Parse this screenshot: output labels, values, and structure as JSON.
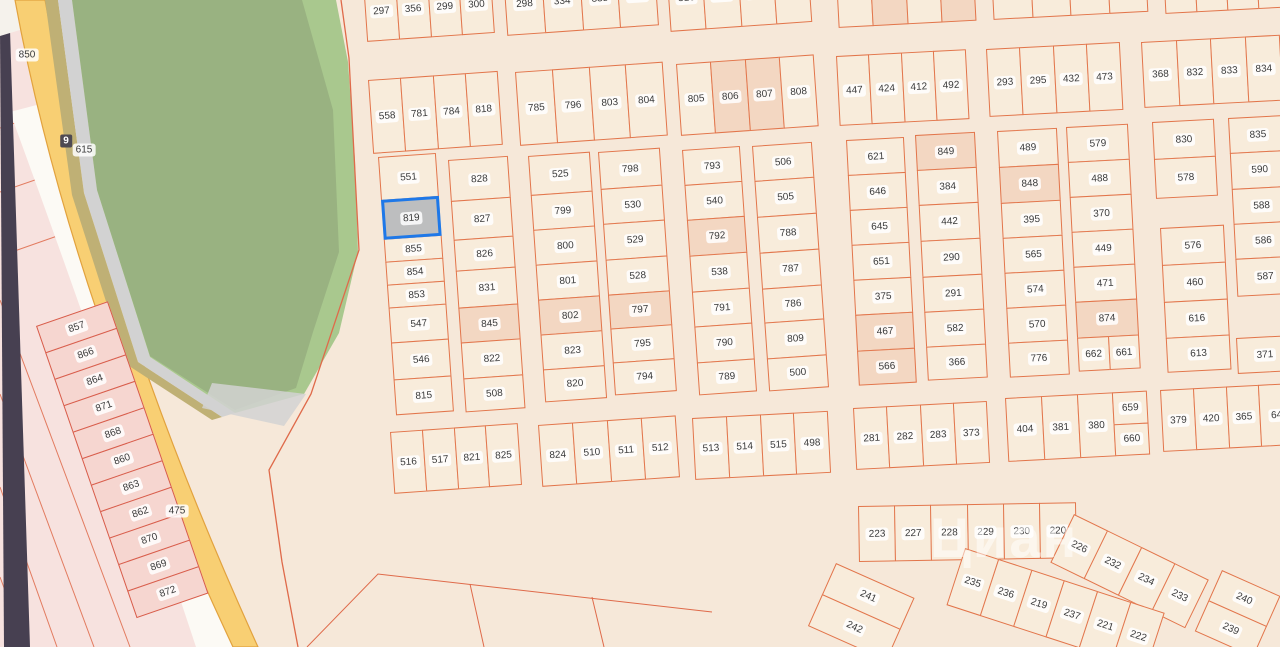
{
  "selected_plot": "819",
  "watermark": {
    "text": "Циан",
    "x": 930,
    "y": 505,
    "size": 56
  },
  "colors": {
    "bg": "#f6e8d9",
    "plot_fill": "#f8ecdb",
    "plot_shade": "#f3d7c2",
    "plot_border": "#e2754b",
    "selected_fill": "#bdbebf",
    "selected_border": "#1e78e8",
    "pink_fill": "#f6d6d0",
    "pink_border": "#d85c4a",
    "label_bg": "rgba(255,255,255,0.85)",
    "label_color": "#3a3a3a",
    "green": "#a9c88e",
    "green_dim": "rgba(95,100,85,0.22)",
    "gray_strip": "#d2d2d2",
    "road_yellow": "#f8cf73",
    "road_edge": "#e2a23e",
    "olive": "#bfb075",
    "white_road": "#fcfaf5",
    "pink_area": "#f7e2df",
    "purple": "#474051",
    "red_line": "#df6a4a",
    "white_wedge": "#f5f2ec",
    "watermark": "rgba(255,255,255,0.5)",
    "badge_dark_bg": "#4e4a52",
    "badge_dark_color": "#ffffff"
  },
  "road_labels": [
    {
      "text": "850",
      "x": 27,
      "y": 55,
      "style": "badge"
    },
    {
      "text": "9",
      "x": 66,
      "y": 141,
      "style": "dark-badge"
    },
    {
      "text": "615",
      "x": 84,
      "y": 150,
      "style": "badge"
    },
    {
      "text": "475",
      "x": 177,
      "y": 511,
      "style": "badge"
    }
  ],
  "blocks": [
    {
      "id": "r1a",
      "kind": "row",
      "x": 363,
      "y": -18,
      "w": 128,
      "h": 60,
      "rot": -4,
      "cells": [
        "297",
        "356",
        "299",
        "300"
      ]
    },
    {
      "id": "r1b",
      "kind": "row",
      "x": 503,
      "y": -26,
      "w": 152,
      "h": 62,
      "rot": -4,
      "cells": [
        "298",
        "334",
        "335",
        "336"
      ]
    },
    {
      "id": "r1c",
      "kind": "row",
      "x": 666,
      "y": -34,
      "w": 142,
      "h": 66,
      "rot": -4,
      "cells": [
        "316",
        "317",
        "318",
        "319"
      ]
    },
    {
      "id": "r1d",
      "kind": "row",
      "x": 835,
      "y": -42,
      "w": 138,
      "h": 70,
      "rot": -3,
      "cells": [
        "",
        {
          "n": "",
          "shade": true
        },
        "",
        {
          "n": "",
          "shade": true
        }
      ]
    },
    {
      "id": "r1e",
      "kind": "row",
      "x": 990,
      "y": -48,
      "w": 155,
      "h": 68,
      "rot": -3,
      "cells": [
        "",
        "",
        "",
        ""
      ]
    },
    {
      "id": "r1f",
      "kind": "row",
      "x": 1162,
      "y": -52,
      "w": 125,
      "h": 66,
      "rot": -3,
      "cells": [
        "",
        "",
        "",
        ""
      ]
    },
    {
      "id": "r2a",
      "kind": "row",
      "x": 368,
      "y": 80,
      "w": 130,
      "h": 74,
      "rot": -4,
      "cells": [
        "558",
        "781",
        "784",
        "818"
      ]
    },
    {
      "id": "r2b",
      "kind": "row",
      "x": 515,
      "y": 72,
      "w": 148,
      "h": 74,
      "rot": -4,
      "cells": [
        "785",
        "796",
        "803",
        "804"
      ]
    },
    {
      "id": "r2c",
      "kind": "row",
      "x": 676,
      "y": 64,
      "w": 138,
      "h": 72,
      "rot": -4,
      "cells": [
        "805",
        {
          "n": "806",
          "shade": true
        },
        {
          "n": "807",
          "shade": true
        },
        "808"
      ]
    },
    {
      "id": "r2d",
      "kind": "row",
      "x": 836,
      "y": 56,
      "w": 130,
      "h": 70,
      "rot": -3,
      "cells": [
        "447",
        "424",
        "412",
        "492"
      ]
    },
    {
      "id": "r2e",
      "kind": "row",
      "x": 986,
      "y": 49,
      "w": 134,
      "h": 68,
      "rot": -3,
      "cells": [
        "293",
        "295",
        "432",
        "473"
      ]
    },
    {
      "id": "r2f",
      "kind": "row",
      "x": 1141,
      "y": 42,
      "w": 139,
      "h": 66,
      "rot": -3,
      "cells": [
        "368",
        "832",
        "833",
        "834"
      ]
    },
    {
      "id": "c1l",
      "kind": "col",
      "x": 378,
      "y": 157,
      "w": 58,
      "rot": -4,
      "cells": [
        {
          "n": "551",
          "h": 44
        },
        {
          "n": "819",
          "h": 40,
          "sel": true
        },
        {
          "n": "855",
          "h": 24
        },
        {
          "n": "854",
          "h": 24
        },
        {
          "n": "853",
          "h": 24
        },
        {
          "n": "547",
          "h": 36
        },
        {
          "n": "546",
          "h": 38
        },
        {
          "n": "815",
          "h": 36
        }
      ]
    },
    {
      "id": "c1r",
      "kind": "col",
      "x": 448,
      "y": 160,
      "w": 60,
      "rot": -4,
      "cells": [
        {
          "n": "828",
          "h": 42
        },
        {
          "n": "827",
          "h": 40
        },
        {
          "n": "826",
          "h": 32
        },
        {
          "n": "831",
          "h": 38
        },
        {
          "n": "845",
          "h": 36,
          "shade": true
        },
        {
          "n": "822",
          "h": 37
        },
        {
          "n": "508",
          "h": 34
        }
      ]
    },
    {
      "id": "c2l",
      "kind": "col",
      "x": 528,
      "y": 156,
      "w": 62,
      "rot": -4,
      "cells": [
        {
          "n": "525",
          "h": 40
        },
        {
          "n": "799",
          "h": 36
        },
        {
          "n": "800",
          "h": 36
        },
        {
          "n": "801",
          "h": 36
        },
        {
          "n": "802",
          "h": 36,
          "shade": true
        },
        {
          "n": "823",
          "h": 36
        },
        {
          "n": "820",
          "h": 33
        }
      ]
    },
    {
      "id": "c2r",
      "kind": "col",
      "x": 598,
      "y": 152,
      "w": 62,
      "rot": -4,
      "cells": [
        {
          "n": "798",
          "h": 38
        },
        {
          "n": "530",
          "h": 36
        },
        {
          "n": "529",
          "h": 37
        },
        {
          "n": "528",
          "h": 36
        },
        {
          "n": "797",
          "h": 35,
          "shade": true
        },
        {
          "n": "795",
          "h": 35
        },
        {
          "n": "794",
          "h": 33
        }
      ]
    },
    {
      "id": "c3l",
      "kind": "col",
      "x": 682,
      "y": 150,
      "w": 58,
      "rot": -4,
      "cells": [
        {
          "n": "793",
          "h": 36
        },
        {
          "n": "540",
          "h": 36
        },
        {
          "n": "792",
          "h": 37,
          "shade": true
        },
        {
          "n": "538",
          "h": 37
        },
        {
          "n": "791",
          "h": 36
        },
        {
          "n": "790",
          "h": 37
        },
        {
          "n": "789",
          "h": 33
        }
      ]
    },
    {
      "id": "c3r",
      "kind": "col",
      "x": 752,
      "y": 146,
      "w": 60,
      "rot": -4,
      "cells": [
        {
          "n": "506",
          "h": 36
        },
        {
          "n": "505",
          "h": 37
        },
        {
          "n": "788",
          "h": 37
        },
        {
          "n": "787",
          "h": 37
        },
        {
          "n": "786",
          "h": 35
        },
        {
          "n": "809",
          "h": 37
        },
        {
          "n": "500",
          "h": 33
        }
      ]
    },
    {
      "id": "c4l",
      "kind": "col",
      "x": 846,
      "y": 140,
      "w": 58,
      "rot": -3,
      "cells": [
        {
          "n": "621",
          "h": 36
        },
        {
          "n": "646",
          "h": 36
        },
        {
          "n": "645",
          "h": 36
        },
        {
          "n": "651",
          "h": 36
        },
        {
          "n": "375",
          "h": 36
        },
        {
          "n": "467",
          "h": 37,
          "shade": true
        },
        {
          "n": "566",
          "h": 35,
          "shade": true
        }
      ]
    },
    {
      "id": "c4r",
      "kind": "col",
      "x": 915,
      "y": 135,
      "w": 60,
      "rot": -3,
      "cells": [
        {
          "n": "849",
          "h": 36,
          "shade": true
        },
        {
          "n": "384",
          "h": 36
        },
        {
          "n": "442",
          "h": 37
        },
        {
          "n": "290",
          "h": 37
        },
        {
          "n": "291",
          "h": 36
        },
        {
          "n": "582",
          "h": 36
        },
        {
          "n": "366",
          "h": 34
        }
      ]
    },
    {
      "id": "c5l",
      "kind": "col",
      "x": 997,
      "y": 131,
      "w": 60,
      "rot": -3,
      "cells": [
        {
          "n": "489",
          "h": 37
        },
        {
          "n": "848",
          "h": 37,
          "shade": true
        },
        {
          "n": "395",
          "h": 36
        },
        {
          "n": "565",
          "h": 36
        },
        {
          "n": "574",
          "h": 36
        },
        {
          "n": "570",
          "h": 36
        },
        {
          "n": "776",
          "h": 35
        }
      ]
    },
    {
      "id": "c5r",
      "kind": "col",
      "x": 1066,
      "y": 127,
      "w": 62,
      "rot": -3,
      "cells": [
        {
          "n": "579",
          "h": 36
        },
        {
          "n": "488",
          "h": 36
        },
        {
          "n": "370",
          "h": 36
        },
        {
          "n": "449",
          "h": 36
        },
        {
          "n": "471",
          "h": 36
        },
        {
          "n": "874",
          "h": 37,
          "shade": true
        },
        {
          "row": [
            "662",
            "661"
          ],
          "h": 34
        }
      ]
    },
    {
      "id": "c6a",
      "kind": "col",
      "x": 1152,
      "y": 122,
      "w": 62,
      "rot": -3,
      "cells": [
        {
          "n": "830",
          "h": 38
        },
        {
          "n": "578",
          "h": 40
        }
      ]
    },
    {
      "id": "c6b",
      "kind": "col",
      "x": 1160,
      "y": 228,
      "w": 64,
      "rot": -3,
      "cells": [
        {
          "n": "576",
          "h": 38
        },
        {
          "n": "460",
          "h": 38
        },
        {
          "n": "616",
          "h": 37
        },
        {
          "n": "613",
          "h": 35
        }
      ]
    },
    {
      "id": "c6c",
      "kind": "col",
      "x": 1228,
      "y": 118,
      "w": 58,
      "rot": -3,
      "cells": [
        {
          "n": "835",
          "h": 36
        },
        {
          "n": "590",
          "h": 37
        },
        {
          "n": "588",
          "h": 36
        },
        {
          "n": "586",
          "h": 36
        },
        {
          "n": "587",
          "h": 38
        }
      ]
    },
    {
      "id": "c6d",
      "kind": "col",
      "x": 1236,
      "y": 338,
      "w": 56,
      "rot": -3,
      "cells": [
        {
          "n": "371",
          "h": 36
        }
      ]
    },
    {
      "id": "bb1",
      "kind": "row",
      "x": 390,
      "y": 432,
      "w": 128,
      "h": 62,
      "rot": -4,
      "cells": [
        "516",
        "517",
        "821",
        "825"
      ]
    },
    {
      "id": "bb2",
      "kind": "row",
      "x": 538,
      "y": 425,
      "w": 138,
      "h": 62,
      "rot": -4,
      "cells": [
        "824",
        "510",
        "511",
        "512"
      ]
    },
    {
      "id": "bb3",
      "kind": "row",
      "x": 692,
      "y": 418,
      "w": 136,
      "h": 62,
      "rot": -3,
      "cells": [
        "513",
        "514",
        "515",
        "498"
      ]
    },
    {
      "id": "bb4",
      "kind": "row",
      "x": 853,
      "y": 408,
      "w": 134,
      "h": 62,
      "rot": -3,
      "cells": [
        "281",
        "282",
        "283",
        "373"
      ]
    },
    {
      "id": "bb5",
      "kind": "row",
      "x": 1005,
      "y": 398,
      "w": 142,
      "h": 64,
      "rot": -3,
      "cells": [
        "404",
        "381",
        "380",
        {
          "stack": [
            "659",
            "660"
          ]
        }
      ]
    },
    {
      "id": "bb6",
      "kind": "row",
      "x": 1160,
      "y": 390,
      "w": 132,
      "h": 62,
      "rot": -3,
      "cells": [
        "379",
        "420",
        "365",
        "64"
      ]
    },
    {
      "id": "fan1",
      "kind": "row",
      "x": 858,
      "y": 506,
      "w": 218,
      "h": 56,
      "rot": -1,
      "cells": [
        "223",
        "227",
        "228",
        "229",
        "230",
        "220"
      ]
    },
    {
      "id": "fan2",
      "kind": "row",
      "x": 1074,
      "y": 514,
      "w": 150,
      "h": 54,
      "rot": 26,
      "cells": [
        "226",
        "232",
        "234",
        "233"
      ]
    },
    {
      "id": "fan2b",
      "kind": "col",
      "x": 1222,
      "y": 570,
      "w": 64,
      "rot": 24,
      "cells": [
        {
          "n": "240",
          "h": 34
        },
        {
          "n": "239",
          "h": 34
        }
      ]
    },
    {
      "id": "fan3",
      "kind": "row",
      "x": 965,
      "y": 548,
      "w": 210,
      "h": 60,
      "rot": 18,
      "cells": [
        "235",
        "236",
        "219",
        "237",
        "221",
        "222"
      ]
    },
    {
      "id": "fan4",
      "kind": "col",
      "x": 836,
      "y": 563,
      "w": 86,
      "rot": 24,
      "cells": [
        {
          "n": "241",
          "h": 35
        },
        {
          "n": "242",
          "h": 35
        }
      ]
    },
    {
      "id": "pinkcol",
      "kind": "col",
      "x": 36,
      "y": 326,
      "w": 76,
      "rot": -19,
      "style": "pink",
      "cells": [
        {
          "n": "857",
          "h": 29
        },
        {
          "n": "866",
          "h": 29
        },
        {
          "n": "864",
          "h": 29
        },
        {
          "n": "871",
          "h": 29
        },
        {
          "n": "868",
          "h": 29
        },
        {
          "n": "860",
          "h": 29
        },
        {
          "n": "863",
          "h": 29
        },
        {
          "n": "862",
          "h": 29
        },
        {
          "n": "870",
          "h": 29
        },
        {
          "n": "869",
          "h": 29
        },
        {
          "n": "872",
          "h": 29
        }
      ]
    }
  ]
}
